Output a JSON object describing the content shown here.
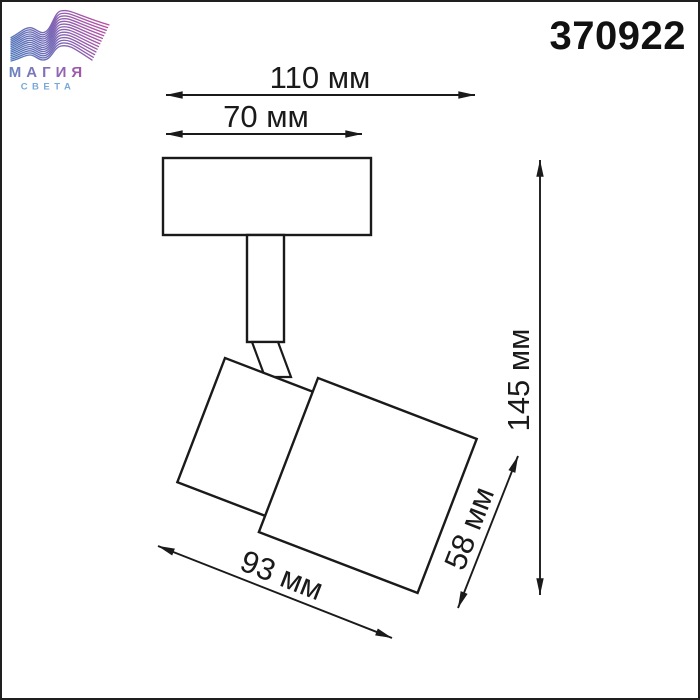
{
  "page": {
    "background": "#ffffff",
    "border_color": "#1f1f1f"
  },
  "header": {
    "brand": {
      "line1": "МАГИЯ",
      "line2": "СВЕТА"
    },
    "product_code": "370922"
  },
  "diagram": {
    "type": "technical-dimension-drawing",
    "dimensions": {
      "overall_width": {
        "label": "110 мм",
        "value_mm": 110
      },
      "plate_width": {
        "label": "70 мм",
        "value_mm": 70
      },
      "overall_height": {
        "label": "145 мм",
        "value_mm": 145
      },
      "head_length": {
        "label": "93 мм",
        "value_mm": 93
      },
      "head_height": {
        "label": "58 мм",
        "value_mm": 58
      }
    }
  },
  "colors": {
    "line": "#1a1a1a",
    "logo_gradient_start": "#4d79bb",
    "logo_gradient_mid": "#7a68b6",
    "logo_gradient_end": "#c2489f",
    "brand_text_start": "#6b84c0",
    "brand_text_end": "#a356ab",
    "brand_sub_text": "#79a9d9"
  }
}
